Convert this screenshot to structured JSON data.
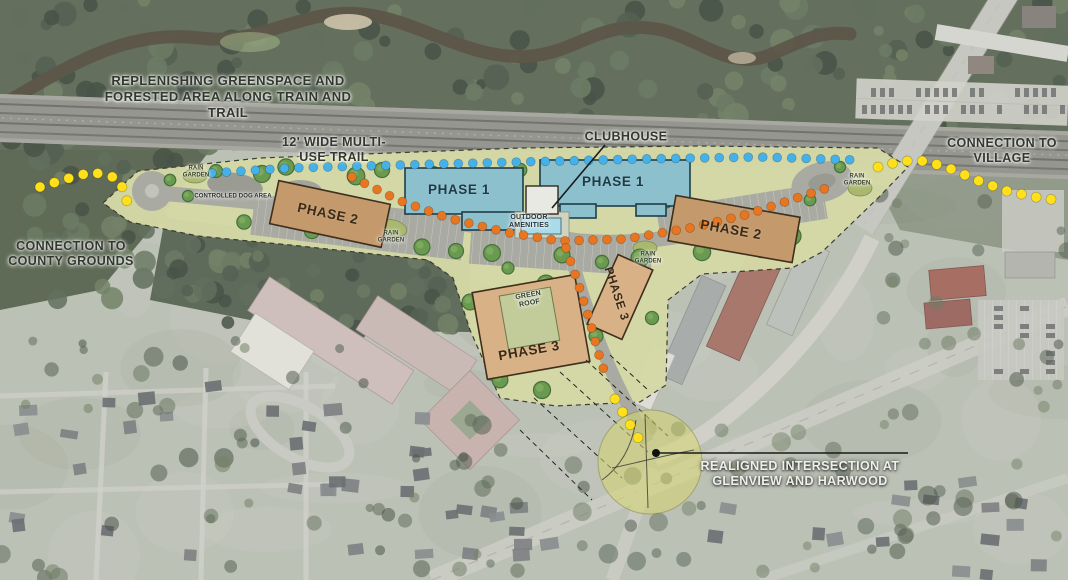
{
  "map_title": "Mixed-use redevelopment master plan aerial rendering",
  "colors": {
    "phase1_fill": "#8cc0cd",
    "phase2_fill": "#c49a6d",
    "phase3_fill": "#d8b286",
    "site_green": "#d5d9a6",
    "trail_blue": "#45b1e8",
    "trail_orange": "#e87520",
    "trail_yellow": "#ffe01a",
    "intersection_highlight": "#d6d670"
  },
  "buildings": {
    "phase1_west": "PHASE 1",
    "phase1_east": "PHASE 1",
    "phase2_west": "PHASE 2",
    "phase2_east": "PHASE 2",
    "phase3_west": "PHASE 3",
    "phase3_east": "PHASE 3"
  },
  "annotations": {
    "greenspace": "REPLENISHING GREENSPACE AND FORESTED AREA ALONG TRAIN AND TRAIL",
    "multi_use_trail": "12' WIDE MULTI-USE TRAIL",
    "clubhouse": "CLUBHOUSE",
    "connection_village": "CONNECTION TO VILLAGE",
    "connection_county": "CONNECTION TO COUNTY GROUNDS",
    "realigned_intersection": "REALIGNED INTERSECTION AT GLENVIEW AND HARWOOD",
    "outdoor_amenities": "OUTDOOR AMENITIES",
    "green_roof": "GREEN ROOF",
    "controlled_dog_area": "CONTROLLED DOG AREA",
    "rain_garden": "RAIN GARDEN"
  },
  "trails": [
    {
      "name": "multi-use-trail",
      "color": "#45b1e8"
    },
    {
      "name": "internal-site-trail",
      "color": "#e87520"
    },
    {
      "name": "connection-trail",
      "color": "#ffe01a"
    }
  ]
}
